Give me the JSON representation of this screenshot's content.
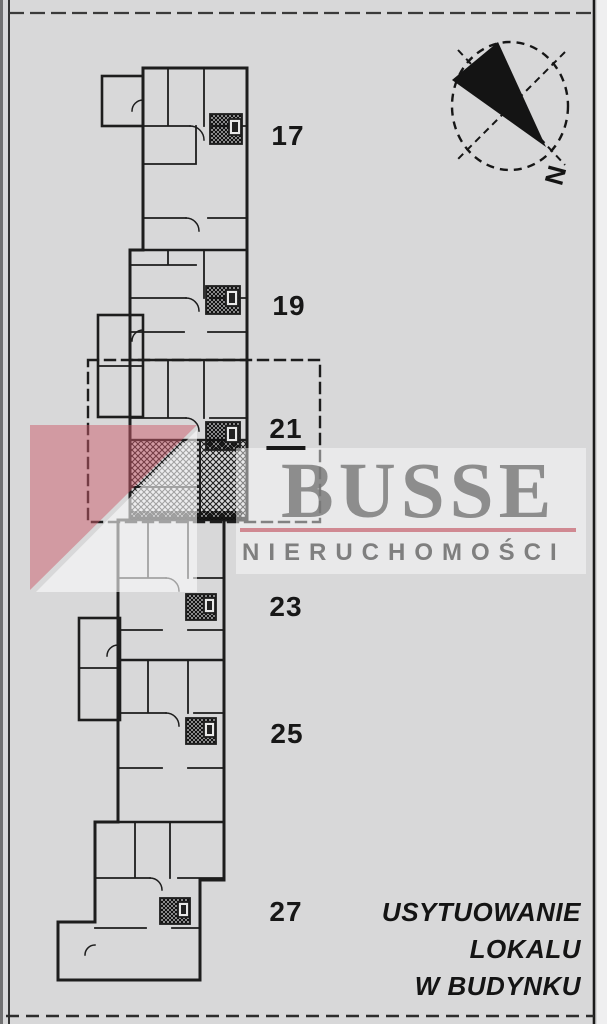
{
  "document": {
    "background_color": "#d8d8d9",
    "ink_color": "#1d1d1d",
    "plan": {
      "type": "building-location-plan",
      "sections": [
        {
          "label": "17",
          "selected": false
        },
        {
          "label": "19",
          "selected": false
        },
        {
          "label": "21",
          "selected": true
        },
        {
          "label": "23",
          "selected": false
        },
        {
          "label": "25",
          "selected": false
        },
        {
          "label": "27",
          "selected": false
        }
      ],
      "selected_section_label": "21"
    },
    "compass": {
      "north_label": "N"
    },
    "watermark": {
      "brand": "BUSSE",
      "subtitle": "NIERUCHOMOŚCI",
      "accent_color": "#c66470",
      "text_color": "#787878"
    },
    "caption": {
      "line1": "USYTUOWANIE",
      "line2": "LOKALU",
      "line3": "W BUDYNKU"
    }
  }
}
